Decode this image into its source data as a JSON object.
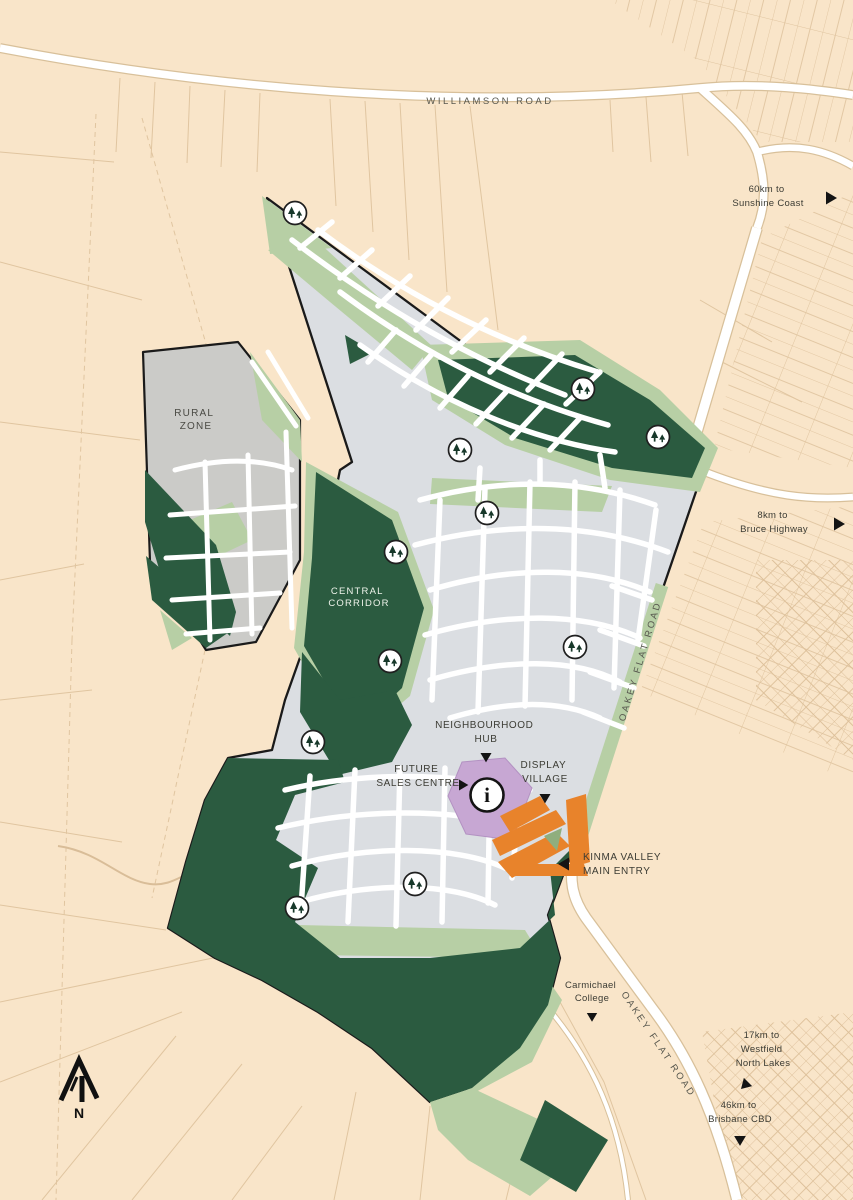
{
  "map_title": "Kinma Valley master plan map",
  "labels": {
    "williamson_road": "WILLIAMSON ROAD",
    "oakey_flat_road": "OAKEY FLAT ROAD",
    "rural_zone": [
      "RURAL",
      "ZONE"
    ],
    "central_corridor": [
      "CENTRAL",
      "CORRIDOR"
    ],
    "neighbourhood_hub": [
      "NEIGHBOURHOOD",
      "HUB"
    ],
    "future_sales_centre": [
      "FUTURE",
      "SALES CENTRE"
    ],
    "display_village": [
      "DISPLAY",
      "VILLAGE"
    ],
    "kinma_valley_main_entry": [
      "KINMA VALLEY",
      "MAIN ENTRY"
    ],
    "carmichael_college": [
      "Carmichael",
      "College"
    ],
    "sunshine_coast": [
      "60km to",
      "Sunshine Coast"
    ],
    "bruce_highway": [
      "8km to",
      "Bruce Highway"
    ],
    "westfield_north_lakes": [
      "17km to",
      "Westfield",
      "North Lakes"
    ],
    "brisbane_cbd": [
      "46km to",
      "Brisbane CBD"
    ],
    "compass_north": "N",
    "info_glyph": "i"
  },
  "colors": {
    "background_beige": "#f9e5c9",
    "parcel_line_tan": "#e0c5a0",
    "road_white": "#ffffff",
    "residential_grey": "#dbdee2",
    "conservation_dark_green": "#2b5b40",
    "open_space_light_green": "#b7cfa5",
    "rural_zone_grey": "#cbcbc8",
    "display_village_orange": "#e8832b",
    "sales_centre_purple": "#c7a7d3",
    "site_boundary_black": "#1a1a1a",
    "label_text": "#3c3c34"
  },
  "markers": {
    "tree_icon_name": "tree-park-icon",
    "tree_positions": [
      [
        295,
        213
      ],
      [
        583,
        389
      ],
      [
        658,
        437
      ],
      [
        460,
        450
      ],
      [
        487,
        513
      ],
      [
        396,
        552
      ],
      [
        575,
        647
      ],
      [
        390,
        661
      ],
      [
        313,
        742
      ],
      [
        415,
        884
      ],
      [
        297,
        908
      ]
    ],
    "info_icon_position": [
      487,
      795
    ]
  }
}
